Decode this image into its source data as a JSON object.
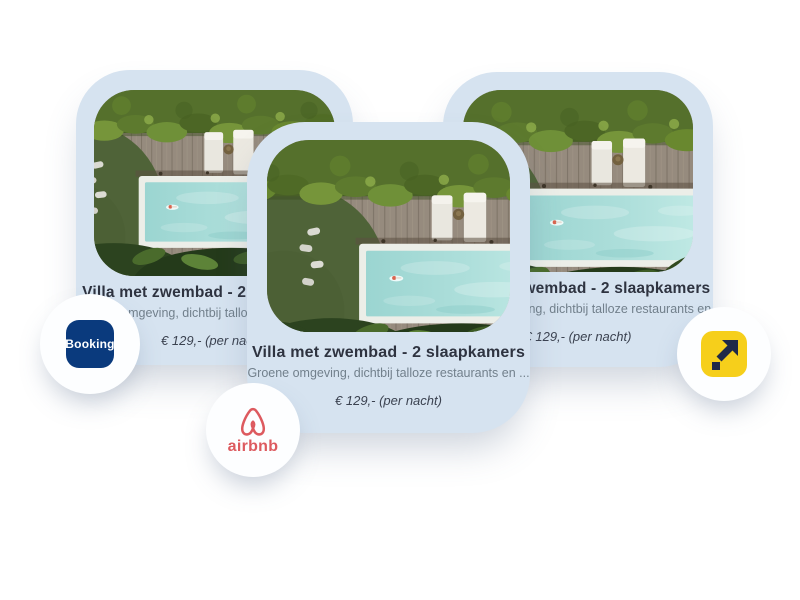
{
  "cards": [
    {
      "title": "Villa met zwembad - 2 slaapkamers",
      "description": "Groene omgeving, dichtbij talloze restaurants en ...",
      "price": "€ 129,- (per nacht)"
    },
    {
      "title": "Villa met zwembad - 2 slaapkamers",
      "description": "Groene omgeving, dichtbij talloze restaurants en ...",
      "price": "€ 129,- (per nacht)"
    },
    {
      "title": "Villa met zwembad - 2 slaapkamers",
      "description": "Groene omgeving, dichtbij talloze restaurants en ...",
      "price": "€ 129,- (per nacht)"
    }
  ],
  "platforms": {
    "booking": {
      "label": "Booking"
    },
    "airbnb": {
      "label": "airbnb"
    },
    "arrow": {
      "label": ""
    }
  },
  "colors": {
    "page_bg": "#ffffff",
    "card_bg": "#d6e3f0",
    "title": "#2e3340",
    "description": "#72808c",
    "price": "#3b4250",
    "booking_bg": "#0a3a7d",
    "booking_fg": "#ffffff",
    "airbnb_red": "#dd5a5f",
    "arrow_bg": "#f6cf1b",
    "arrow_fg": "#1f2948"
  }
}
